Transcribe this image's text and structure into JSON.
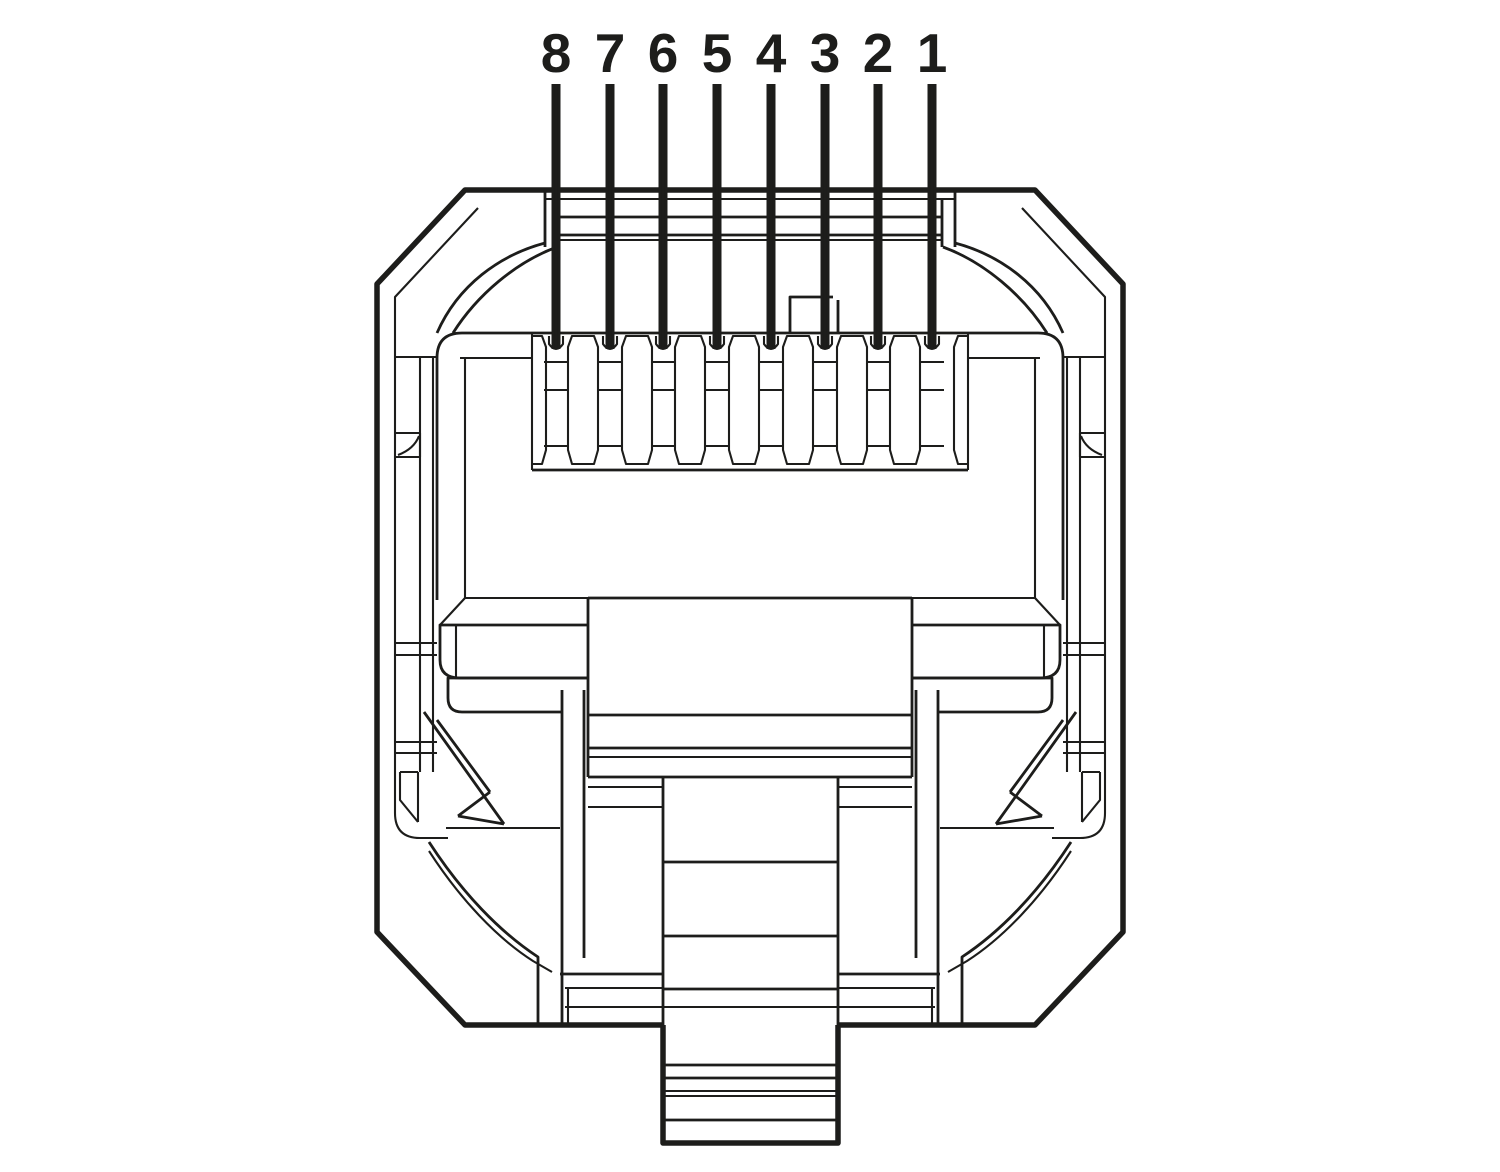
{
  "figure": {
    "description": "Front-face technical line drawing of an 8-position modular connector plug (RJ45 / 8P8C) with numbered contacts and leader lines",
    "background_color": "#ffffff",
    "line_color": "#1d1d1b",
    "width": 1500,
    "height": 1172
  },
  "pins": {
    "count": 8,
    "note": "numbered right-to-left: pin 1 is rightmost",
    "labels": [
      {
        "label": "8",
        "x": 556
      },
      {
        "label": "7",
        "x": 610
      },
      {
        "label": "6",
        "x": 663
      },
      {
        "label": "5",
        "x": 717
      },
      {
        "label": "4",
        "x": 771
      },
      {
        "label": "3",
        "x": 825
      },
      {
        "label": "2",
        "x": 878
      },
      {
        "label": "1",
        "x": 932
      }
    ],
    "label_y": 72,
    "leader_top_y": 84,
    "leader_bottom_y": 349
  }
}
